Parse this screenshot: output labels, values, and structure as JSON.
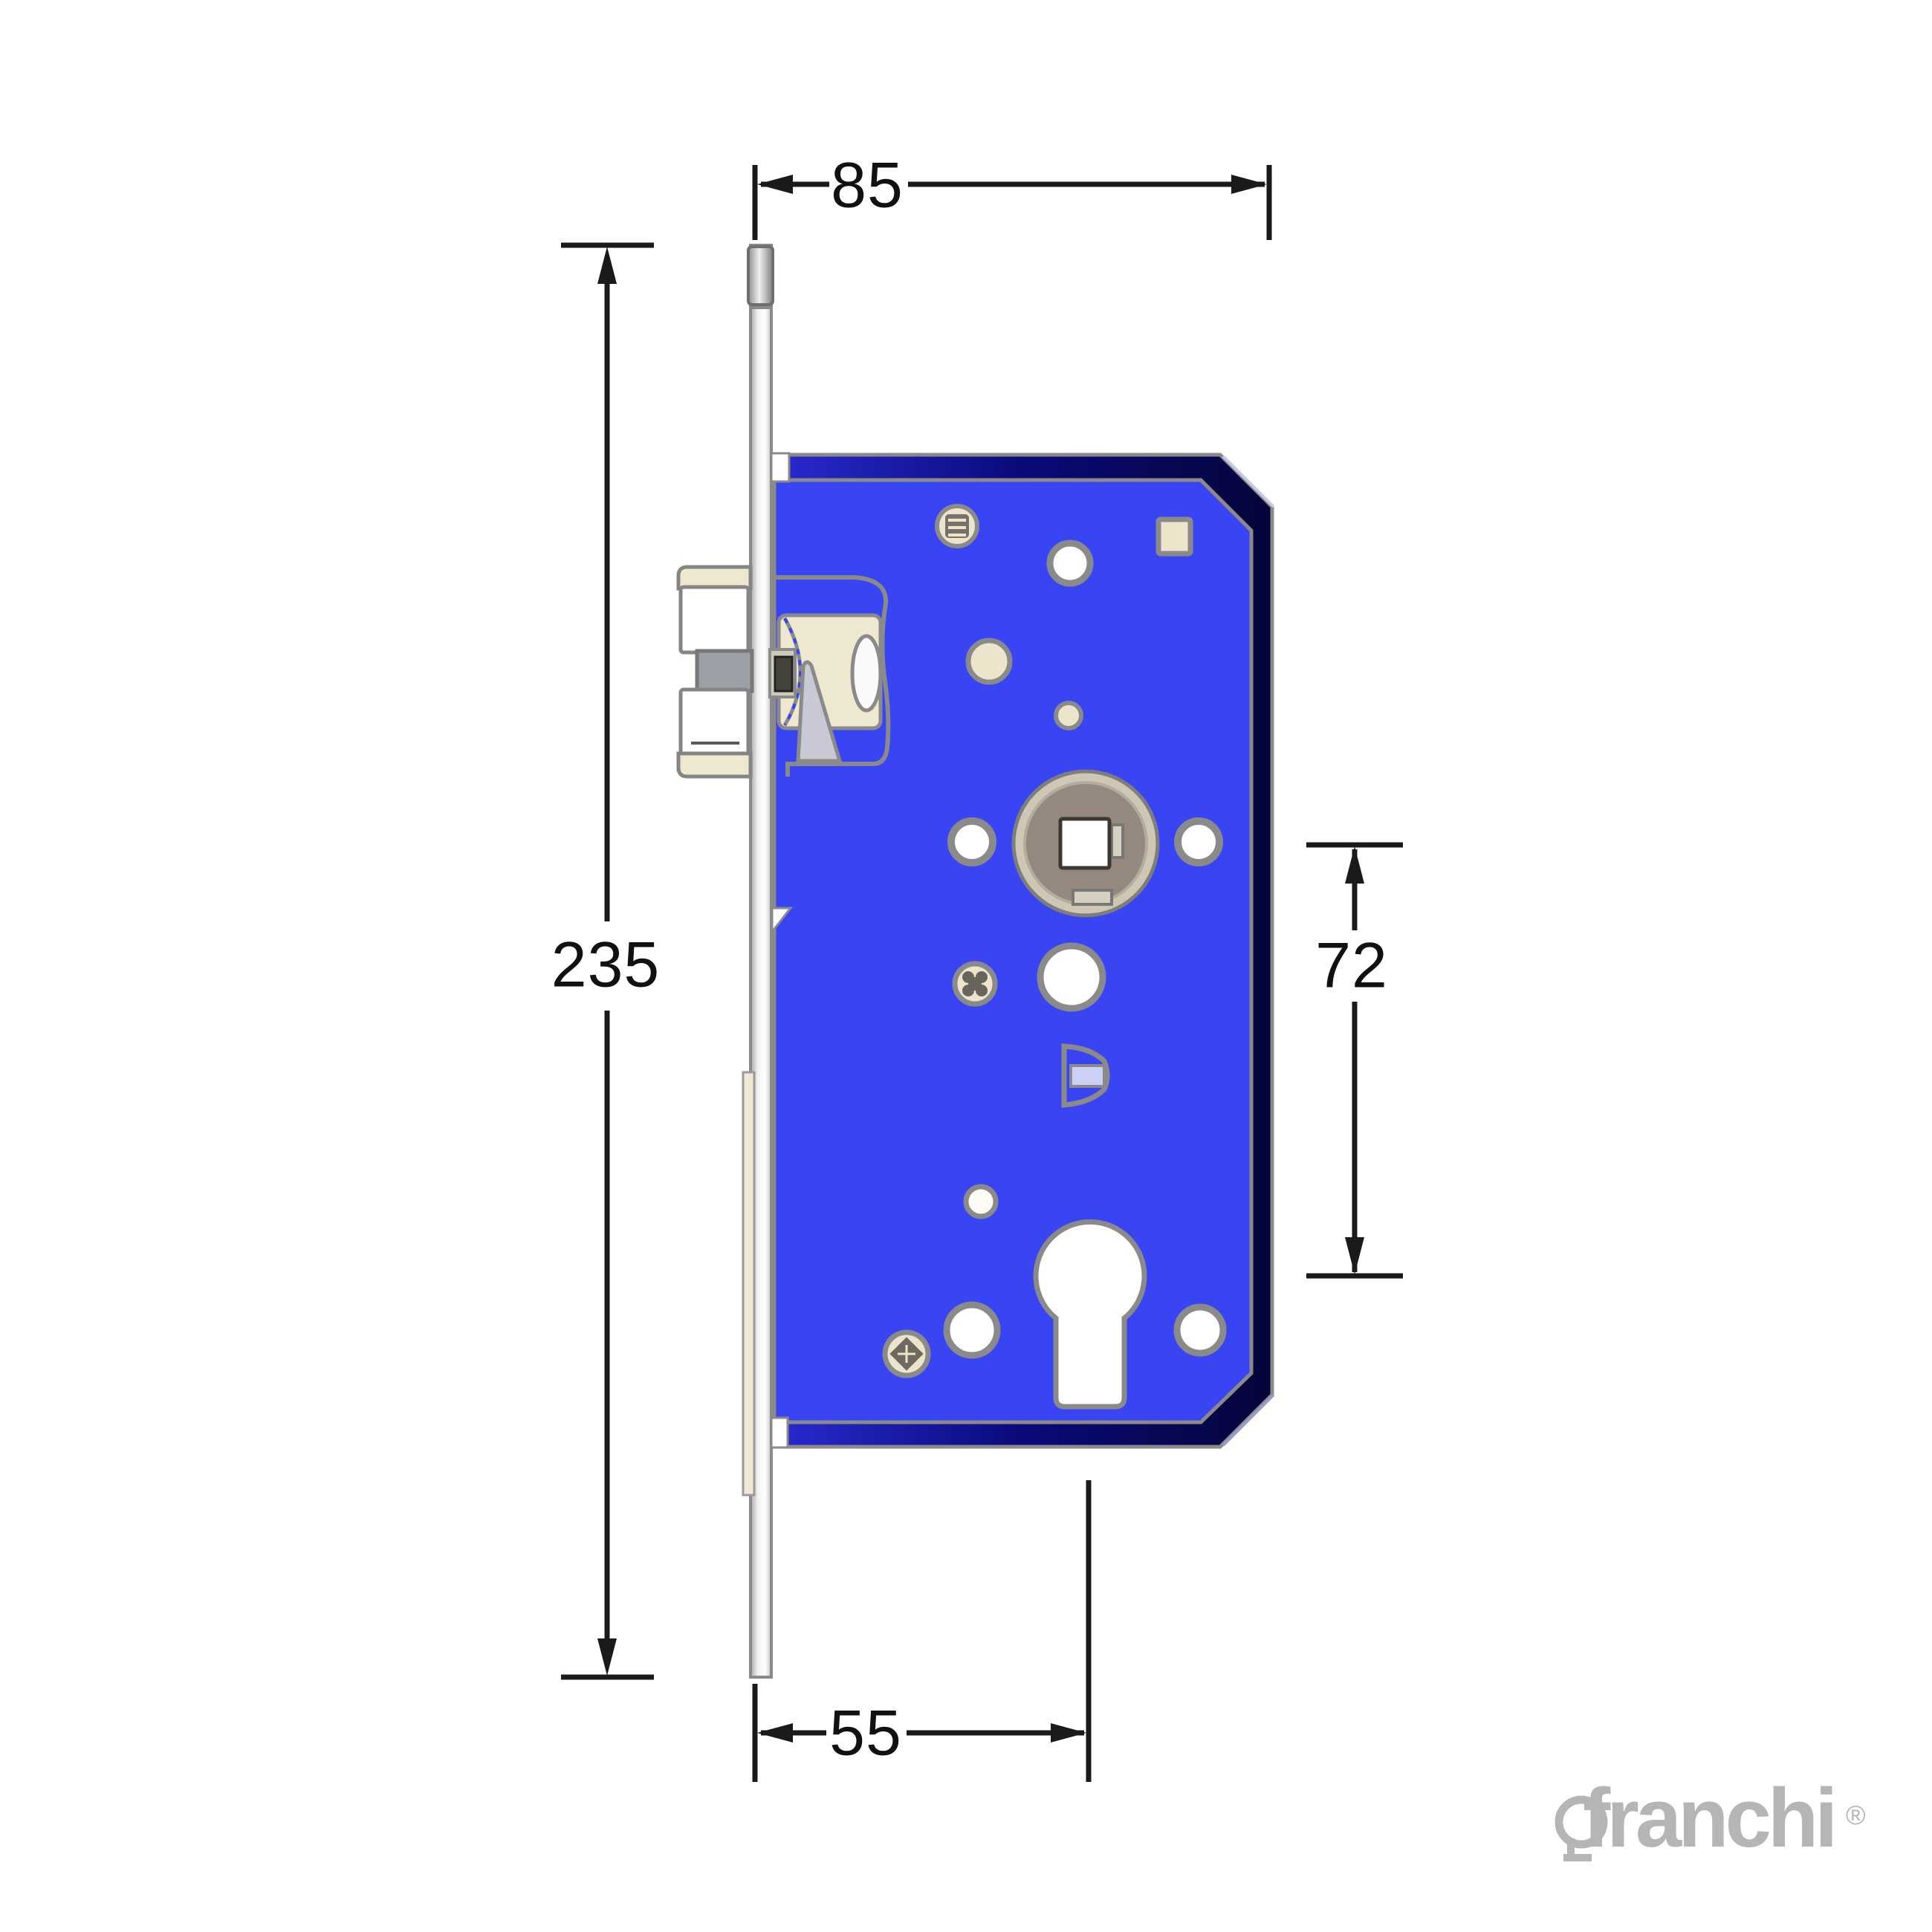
{
  "drawing": {
    "subject": "mortise-lock-technical-drawing",
    "dimensions": {
      "lock_case_width_top": "85",
      "faceplate_height_left": "235",
      "follower_to_cylinder_right": "72",
      "backset_bottom": "55"
    },
    "logo": {
      "brand": "franchi",
      "registered_mark": "®"
    },
    "colors": {
      "body_blue": "#3945f2",
      "body_edge_navy": "#0d0d85",
      "outline_gray": "#8a8a8a",
      "hole_cream": "#ece5cc",
      "hub_taupe": "#95897f",
      "hub_ring_beige": "#cec7b4",
      "wedge_gray": "#c9c9d6",
      "latch_gray": "#9aa0a6",
      "dimension_black": "#1a1a1a",
      "logo_gray": "#b5b5b5",
      "cylinder_slot_white": "#ffffff",
      "d_bracket_inner": "#ccd0f4"
    }
  }
}
